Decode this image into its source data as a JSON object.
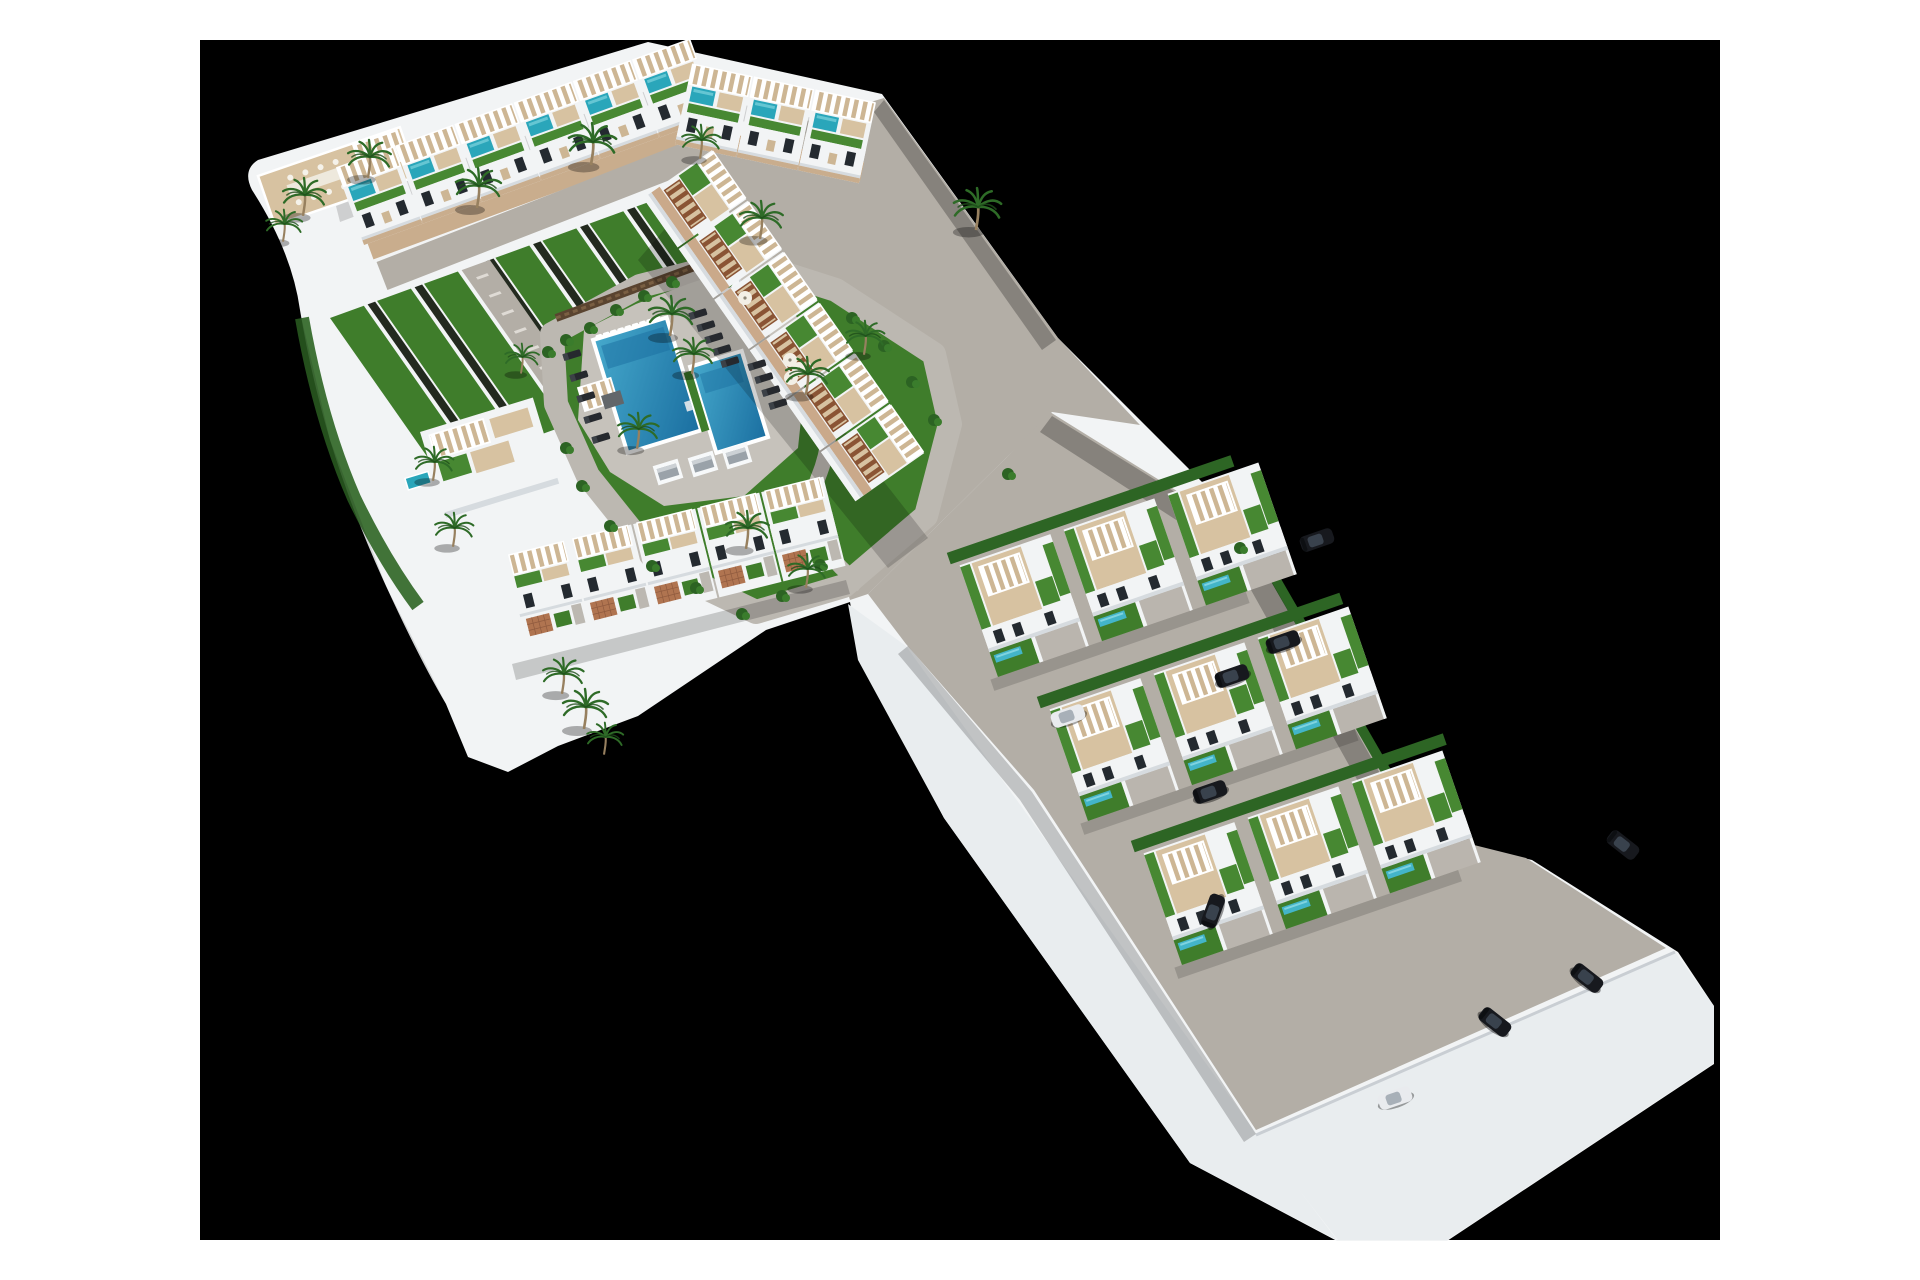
{
  "scene": {
    "description": "aerial-3d-architectural-render-of-residential-development-with-communal-pool-gardens-townhouse-rows-and-villa-rows",
    "background_color": "#000000",
    "page_color": "#ffffff",
    "stage": {
      "x": 200,
      "y": 40,
      "width": 1520,
      "height": 1200
    }
  },
  "palette": {
    "building_white": "#f2f4f5",
    "building_shade": "#d6dbdf",
    "platform_face": "#e9edef",
    "road_gray": "#b3aea6",
    "driveway_gray": "#bab5ae",
    "street_tan": "#c9ad8d",
    "path_gray": "#bcb8b1",
    "lawn_green": "#3f7d2b",
    "roof_turf_green": "#478832",
    "hedge_green": "#2d6524",
    "strip_separator": "#232a1f",
    "deck_wood": "#d7c2a1",
    "deck_wood_dark": "#cdb694",
    "terracotta": "#b07450",
    "roof_pool_teal": "#2aa6ba",
    "villa_pool_teal": "#43b5c9",
    "window_dark": "#242a30",
    "stone_wall_brown": "#5a4430",
    "pergola_brown": "#8a5434",
    "car_dark": "#17191e",
    "car_white": "#e9ebee"
  },
  "inventory": {
    "townhouse_rows": 4,
    "townhouse_units_visible": 20,
    "villa_rows": 3,
    "villas": 9,
    "communal_pool_basins": 2,
    "sun_loungers": 14,
    "parasols": 4,
    "cabanas": 3,
    "palm_trees": 21,
    "parked_cars": 10,
    "fountain": 1
  },
  "apartments": {
    "row_north_a": {
      "x": 336,
      "y": 168,
      "angle": -20,
      "units": 6,
      "pitch": 63
    },
    "row_north_b": {
      "x": 692,
      "y": 64,
      "angle": 12,
      "units": 3,
      "pitch": 63
    },
    "row_east_diagonal": {
      "x": 712,
      "y": 150,
      "angle": 55,
      "units": 6,
      "pitch": 62
    },
    "row_south_wing": {
      "x": 505,
      "y": 556,
      "angle": -14,
      "units": 5,
      "pitch": 66
    }
  },
  "villas": {
    "rows": [
      {
        "x": 952,
        "y": 568,
        "angle": -19,
        "hedge_len": 300,
        "villas_x": [
          8,
          118,
          228
        ]
      },
      {
        "x": 1042,
        "y": 712,
        "angle": -19,
        "hedge_len": 320,
        "villas_x": [
          8,
          118,
          228
        ]
      },
      {
        "x": 1136,
        "y": 856,
        "angle": -19,
        "hedge_len": 330,
        "villas_x": [
          8,
          118,
          228
        ]
      }
    ]
  },
  "garden_strips": {
    "matrix": [
      0.574,
      0.819,
      0.94,
      -0.342,
      330,
      318
    ],
    "strips": [
      {
        "y": 0,
        "len": 195
      },
      {
        "y": 50,
        "len": 195
      },
      {
        "y": 100,
        "len": 188
      },
      {
        "y": 176,
        "len": 170
      },
      {
        "y": 226,
        "len": 138
      },
      {
        "y": 276,
        "len": 112
      },
      {
        "y": 326,
        "len": 92
      }
    ],
    "spine": {
      "y": 140,
      "len": 205,
      "w": 30,
      "ticks": 9
    }
  },
  "pool_furniture": {
    "angle": -17,
    "loungers": [
      [
        698,
        314
      ],
      [
        706,
        326
      ],
      [
        714,
        338
      ],
      [
        722,
        350
      ],
      [
        730,
        362
      ],
      [
        757,
        365
      ],
      [
        764,
        378
      ],
      [
        771,
        391
      ],
      [
        778,
        404
      ],
      [
        572,
        355
      ],
      [
        579,
        376
      ],
      [
        586,
        397
      ],
      [
        593,
        418
      ],
      [
        601,
        438
      ]
    ],
    "umbrellas": [
      [
        745,
        298
      ],
      [
        790,
        360
      ],
      [
        799,
        369
      ],
      [
        791,
        378
      ]
    ],
    "cabanas": [
      [
        668,
        472
      ],
      [
        703,
        464
      ],
      [
        737,
        456
      ]
    ]
  },
  "palms": [
    [
      670,
      334,
      1
    ],
    [
      692,
      372,
      0.9
    ],
    [
      303,
      214,
      0.95
    ],
    [
      283,
      240,
      0.8
    ],
    [
      368,
      176,
      0.95
    ],
    [
      477,
      206,
      1
    ],
    [
      591,
      163,
      1.05
    ],
    [
      700,
      157,
      0.85
    ],
    [
      760,
      237,
      0.95
    ],
    [
      976,
      228,
      1.05
    ],
    [
      864,
      353,
      0.85
    ],
    [
      806,
      393,
      0.95
    ],
    [
      746,
      547,
      0.95
    ],
    [
      806,
      586,
      0.85
    ],
    [
      433,
      479,
      0.85
    ],
    [
      453,
      545,
      0.85
    ],
    [
      562,
      692,
      0.9
    ],
    [
      584,
      727,
      1
    ],
    [
      604,
      753,
      0.8
    ],
    [
      521,
      372,
      0.75
    ],
    [
      637,
      447,
      0.9
    ]
  ],
  "bushes": [
    [
      548,
      352
    ],
    [
      566,
      340
    ],
    [
      590,
      328
    ],
    [
      616,
      310
    ],
    [
      644,
      296
    ],
    [
      672,
      282
    ],
    [
      852,
      318
    ],
    [
      884,
      346
    ],
    [
      912,
      382
    ],
    [
      934,
      420
    ],
    [
      820,
      565
    ],
    [
      782,
      596
    ],
    [
      742,
      614
    ],
    [
      696,
      588
    ],
    [
      652,
      566
    ],
    [
      610,
      526
    ],
    [
      582,
      486
    ],
    [
      566,
      448
    ],
    [
      1008,
      474
    ],
    [
      1240,
      548
    ]
  ],
  "cars": [
    {
      "x": 1283,
      "y": 642,
      "r": -19,
      "t": "dark"
    },
    {
      "x": 1317,
      "y": 540,
      "r": -19,
      "t": "dark"
    },
    {
      "x": 1232,
      "y": 676,
      "r": -19,
      "t": "dark"
    },
    {
      "x": 1068,
      "y": 716,
      "r": -19,
      "t": "white"
    },
    {
      "x": 1213,
      "y": 911,
      "r": -70,
      "t": "dark"
    },
    {
      "x": 1210,
      "y": 792,
      "r": -19,
      "t": "dark"
    },
    {
      "x": 1495,
      "y": 1022,
      "r": 38,
      "t": "dark"
    },
    {
      "x": 1587,
      "y": 978,
      "r": 38,
      "t": "dark"
    },
    {
      "x": 1623,
      "y": 845,
      "r": 38,
      "t": "dark"
    },
    {
      "x": 1395,
      "y": 1098,
      "r": -19,
      "t": "white"
    }
  ],
  "shadows": [
    {
      "pts": "884,100 1056,340 1042,350 874,112",
      "o": 0.25
    },
    {
      "pts": "1052,416 1246,536 1412,830 1392,842 1232,556 1040,432",
      "o": 0.25
    },
    {
      "pts": "676,216 928,538 888,568 638,260",
      "o": 0.18
    },
    {
      "pts": "336,206 654,88 866,128 862,144 652,104 340,222",
      "o": 0.15
    },
    {
      "pts": "512,664 846,580 850,594 516,680",
      "o": 0.18
    },
    {
      "pts": "908,646 1032,792 1256,1134 1244,1142 1020,800 898,654",
      "o": 0.2
    },
    {
      "pts": "300,312 330,440 386,586 446,704 436,712 374,592 318,444 290,314",
      "o": 0.12
    }
  ]
}
